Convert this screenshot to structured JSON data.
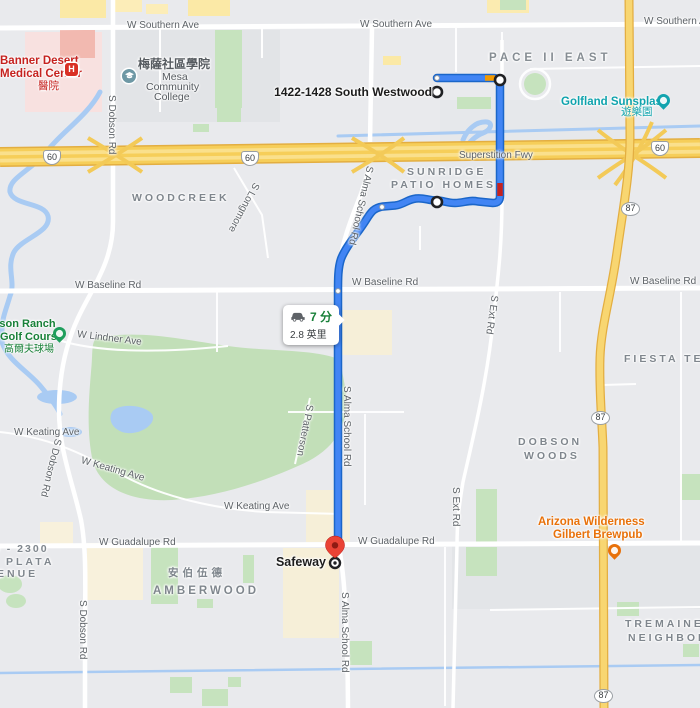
{
  "route_info": {
    "duration": "7 分",
    "distance": "2.8 英里"
  },
  "markers": {
    "origin_label": "1422-1428 South Westwood",
    "destination_label": "Safeway"
  },
  "shields": {
    "us60": "60",
    "az87": "87"
  },
  "streets": {
    "southern_ave": "W Southern Ave",
    "superstition": "Superstition Fwy",
    "baseline": "W Baseline Rd",
    "guadalupe": "W Guadalupe Rd",
    "keating": "W Keating Ave",
    "lindner": "W Lindner Ave",
    "dobson": "S Dobson Rd",
    "alma": "S Alma School Rd",
    "ext": "S Ext Rd",
    "longmore": "S Longmore",
    "patterson": "S Patterson"
  },
  "neighborhoods": {
    "pace": "PACE II EAST",
    "sunridge_1": "SUNRIDGE",
    "sunridge_2": "PATIO HOMES",
    "woodcreek": "WOODCREEK",
    "dobson_woods_1": "DOBSON",
    "dobson_woods_2": "WOODS",
    "fiesta": "FIESTA TECH",
    "amberwood": "AMBERWOOD",
    "amberwood_zh": "安伯伍德",
    "tremaine_1": "TREMAINE",
    "tremaine_2": "NEIGHBORHOOD",
    "plata_1": "0 - 2300",
    "plata_2": "PLATA",
    "plata_3": "ENUE"
  },
  "pois": {
    "banner_1": "Banner Desert",
    "banner_2": "Medical Center",
    "banner_zh": "醫院",
    "mesa_zh": "梅薩社區學院",
    "mesa_1": "Mesa",
    "mesa_2": "Community",
    "mesa_3": "College",
    "golfland": "Golfland Sunsplash",
    "golfland_zh": "遊樂園",
    "golf_1": "Dobson Ranch",
    "golf_2": "Golf Course",
    "golf_zh": "高爾夫球場",
    "brewpub_1": "Arizona Wilderness",
    "brewpub_2": "Gilbert Brewpub"
  },
  "colors": {
    "route_blue": "#4285F4",
    "route_casing": "#1B66C9",
    "traffic_red": "#C5221F",
    "traffic_orange": "#F29900",
    "highway_yellow": "#F6CE59",
    "water_blue": "#A9CBF3",
    "park_green": "#C6E3BE",
    "destination_pin_red": "#EA4335",
    "time_green": "#188038"
  }
}
